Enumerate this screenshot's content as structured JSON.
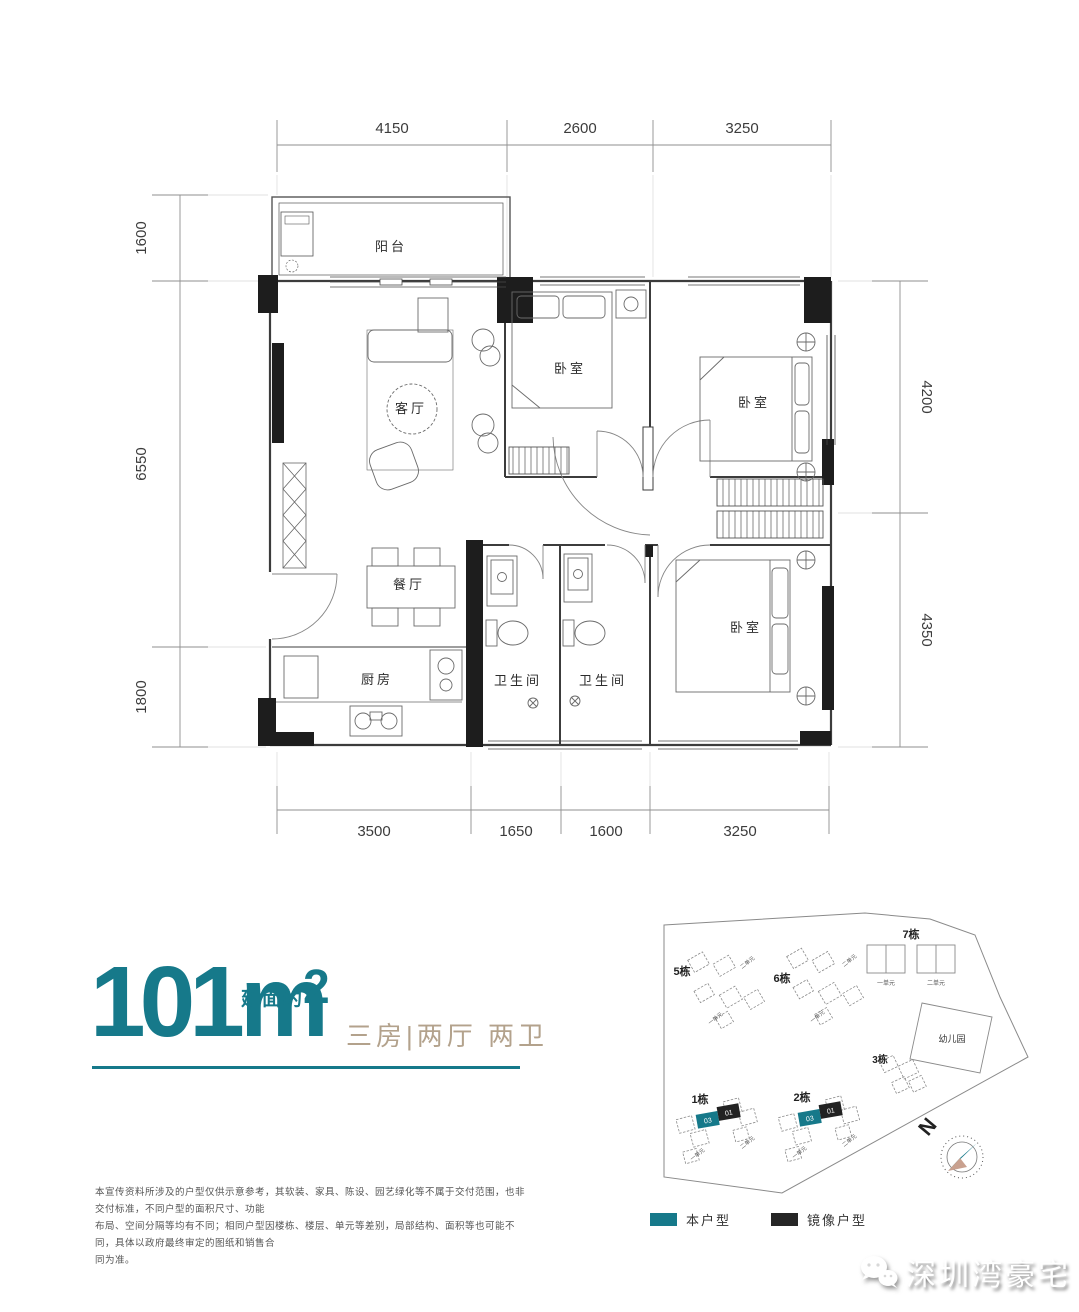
{
  "colors": {
    "accent_teal": "#16798A",
    "tan": "#B3A28C",
    "wall_black": "#1D1D1D"
  },
  "floor_plan": {
    "rooms": [
      {
        "label": "阳台"
      },
      {
        "label": "客厅"
      },
      {
        "label": "卧室"
      },
      {
        "label": "卧室"
      },
      {
        "label": "餐厅"
      },
      {
        "label": "厨房"
      },
      {
        "label": "卫生间"
      },
      {
        "label": "卫生间"
      },
      {
        "label": "卧室"
      }
    ],
    "dimensions": {
      "top": [
        "4150",
        "2600",
        "3250"
      ],
      "bottom": [
        "3500",
        "1650",
        "1600",
        "3250"
      ],
      "left": [
        "1600",
        "6550",
        "1800"
      ],
      "right": [
        "4200",
        "4350"
      ]
    }
  },
  "area_block": {
    "number": "101",
    "unit": "m",
    "prefix": "建面约",
    "superscript": "2",
    "layout_text": "三房|两厅 两卫"
  },
  "disclaimer": {
    "line1": "本宣传资料所涉及的户型仅供示意参考，其软装、家具、陈设、园艺绿化等不属于交付范围，也非交付标准，不同户型的面积尺寸、功能",
    "line2": "布局、空间分隔等均有不同；相同户型因楼栋、楼层、单元等差别，局部结构、面积等也可能不同，具体以政府最终审定的图纸和销售合",
    "line3": "同为准。"
  },
  "site_plan": {
    "buildings": [
      {
        "name": "5栋"
      },
      {
        "name": "6栋"
      },
      {
        "name": "7栋"
      },
      {
        "name": "3栋"
      },
      {
        "name": "1栋"
      },
      {
        "name": "2栋"
      }
    ],
    "kindergarten_label": "幼儿园",
    "unit_labels": [
      "一单元",
      "二单元"
    ],
    "highlight": {
      "self_unit": "03",
      "mirror_unit": "01"
    },
    "north_label": "N"
  },
  "legend": {
    "self_label": "本户型",
    "mirror_label": "镜像户型"
  },
  "watermark": {
    "text": "深圳湾豪宅"
  }
}
